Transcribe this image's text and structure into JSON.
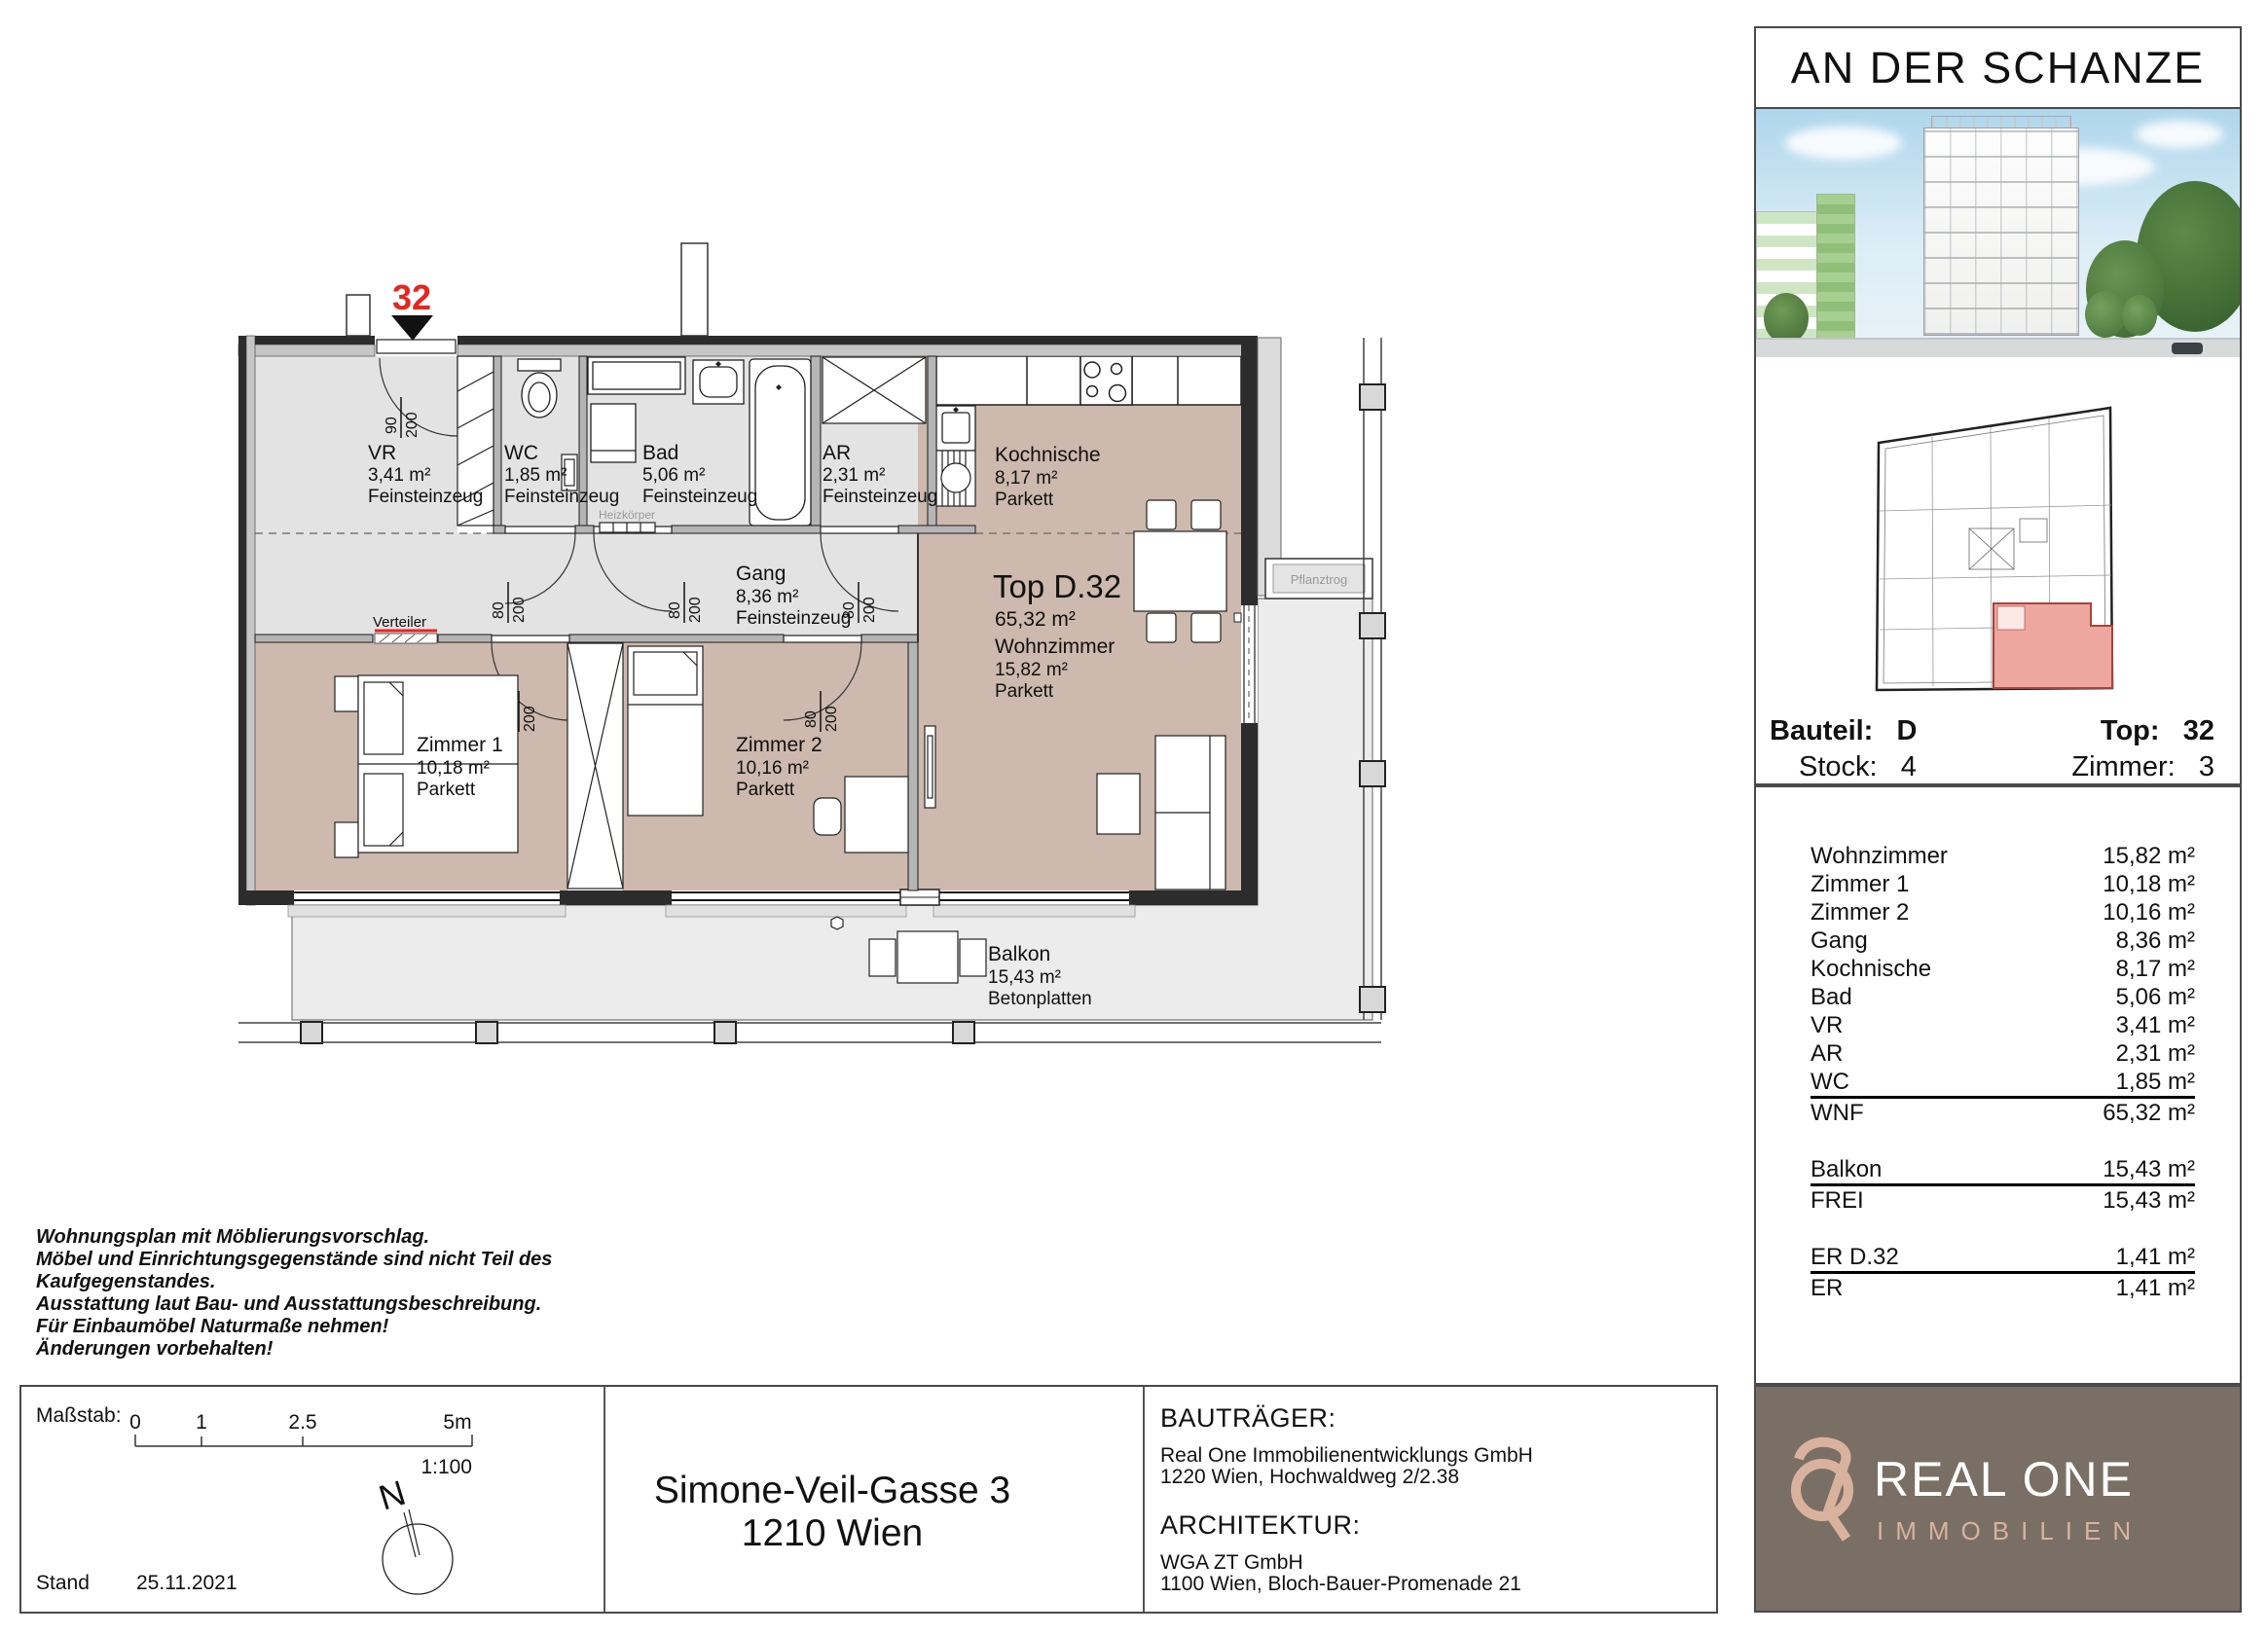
{
  "plan": {
    "marker": "32",
    "door_dims": {
      "d80": "80",
      "d90": "90",
      "h200": "200"
    },
    "rooms": {
      "vr": {
        "name": "VR",
        "area": "3,41 m²",
        "floor": "Feinsteinzeug"
      },
      "wc": {
        "name": "WC",
        "area": "1,85 m²",
        "floor": "Feinsteinzeug"
      },
      "bad": {
        "name": "Bad",
        "area": "5,06 m²",
        "floor": "Feinsteinzeug"
      },
      "ar": {
        "name": "AR",
        "area": "2,31 m²",
        "floor": "Feinsteinzeug"
      },
      "kochnische": {
        "name": "Kochnische",
        "area": "8,17 m²",
        "floor": "Parkett"
      },
      "gang": {
        "name": "Gang",
        "area": "8,36 m²",
        "floor": "Feinsteinzeug"
      },
      "unit": {
        "name": "Top D.32",
        "area": "65,32 m²"
      },
      "wohnzimmer": {
        "name": "Wohnzimmer",
        "area": "15,82 m²",
        "floor": "Parkett"
      },
      "zimmer1": {
        "name": "Zimmer 1",
        "area": "10,18 m²",
        "floor": "Parkett"
      },
      "zimmer2": {
        "name": "Zimmer 2",
        "area": "10,16 m²",
        "floor": "Parkett"
      },
      "balkon": {
        "name": "Balkon",
        "area": "15,43 m²",
        "floor": "Betonplatten"
      }
    },
    "annotations": {
      "verteiler": "Verteiler",
      "heizkoerper": "Heizkörper",
      "pflanztrog": "Pflanztrog"
    }
  },
  "sidebar": {
    "title": "AN DER SCHANZE",
    "unit_info": {
      "bauteil_label": "Bauteil:",
      "bauteil": "D",
      "stock_label": "Stock:",
      "stock": "4",
      "top_label": "Top:",
      "top": "32",
      "zimmer_label": "Zimmer:",
      "zimmer": "3"
    },
    "table": {
      "rows": [
        {
          "label": "Wohnzimmer",
          "value": "15,82 m²"
        },
        {
          "label": "Zimmer 1",
          "value": "10,18 m²"
        },
        {
          "label": "Zimmer 2",
          "value": "10,16 m²"
        },
        {
          "label": "Gang",
          "value": "8,36 m²"
        },
        {
          "label": "Kochnische",
          "value": "8,17 m²"
        },
        {
          "label": "Bad",
          "value": "5,06 m²"
        },
        {
          "label": "VR",
          "value": "3,41 m²"
        },
        {
          "label": "AR",
          "value": "2,31 m²"
        },
        {
          "label": "WC",
          "value": "1,85 m²"
        },
        {
          "label": "WNF",
          "value": "65,32 m²"
        },
        {
          "label": "Balkon",
          "value": "15,43 m²"
        },
        {
          "label": "FREI",
          "value": "15,43 m²"
        },
        {
          "label": "ER D.32",
          "value": "1,41 m²"
        },
        {
          "label": "ER",
          "value": "1,41 m²"
        }
      ]
    },
    "logo": {
      "name": "REAL ONE",
      "sub": "IMMOBILIEN"
    }
  },
  "footer": {
    "disclaimer": [
      "Wohnungsplan mit Möblierungsvorschlag.",
      "Möbel und Einrichtungsgegenstände sind nicht Teil des",
      "Kaufgegenstandes.",
      "Ausstattung laut Bau- und Ausstattungsbeschreibung.",
      "Für Einbaumöbel Naturmaße nehmen!",
      "Änderungen vorbehalten!"
    ],
    "scale": {
      "label": "Maßstab:",
      "t0": "0",
      "t1": "1",
      "t25": "2.5",
      "t5": "5m",
      "ratio": "1:100",
      "stand_label": "Stand",
      "stand_date": "25.11.2021",
      "north": "N"
    },
    "address": {
      "line1": "Simone-Veil-Gasse 3",
      "line2": "1210 Wien"
    },
    "developer": {
      "heading": "BAUTRÄGER:",
      "name": "Real One Immobilienentwicklungs GmbH",
      "address": "1220 Wien, Hochwaldweg 2/2.38"
    },
    "architect": {
      "heading": "ARCHITEKTUR:",
      "name": "WGA ZT GmbH",
      "address": "1100 Wien, Bloch-Bauer-Promenade 21"
    }
  },
  "colors": {
    "accent_red": "#e8251f",
    "parkett": "#cdb9ad",
    "tile": "#e3e3e3",
    "balcony": "#ececec",
    "wall_dark": "#2c2c2c",
    "wall_gray": "#b5b5b5",
    "logo_bg": "#7a6f65",
    "logo_accent": "#d9b29e",
    "highlight": "#eda79f"
  }
}
